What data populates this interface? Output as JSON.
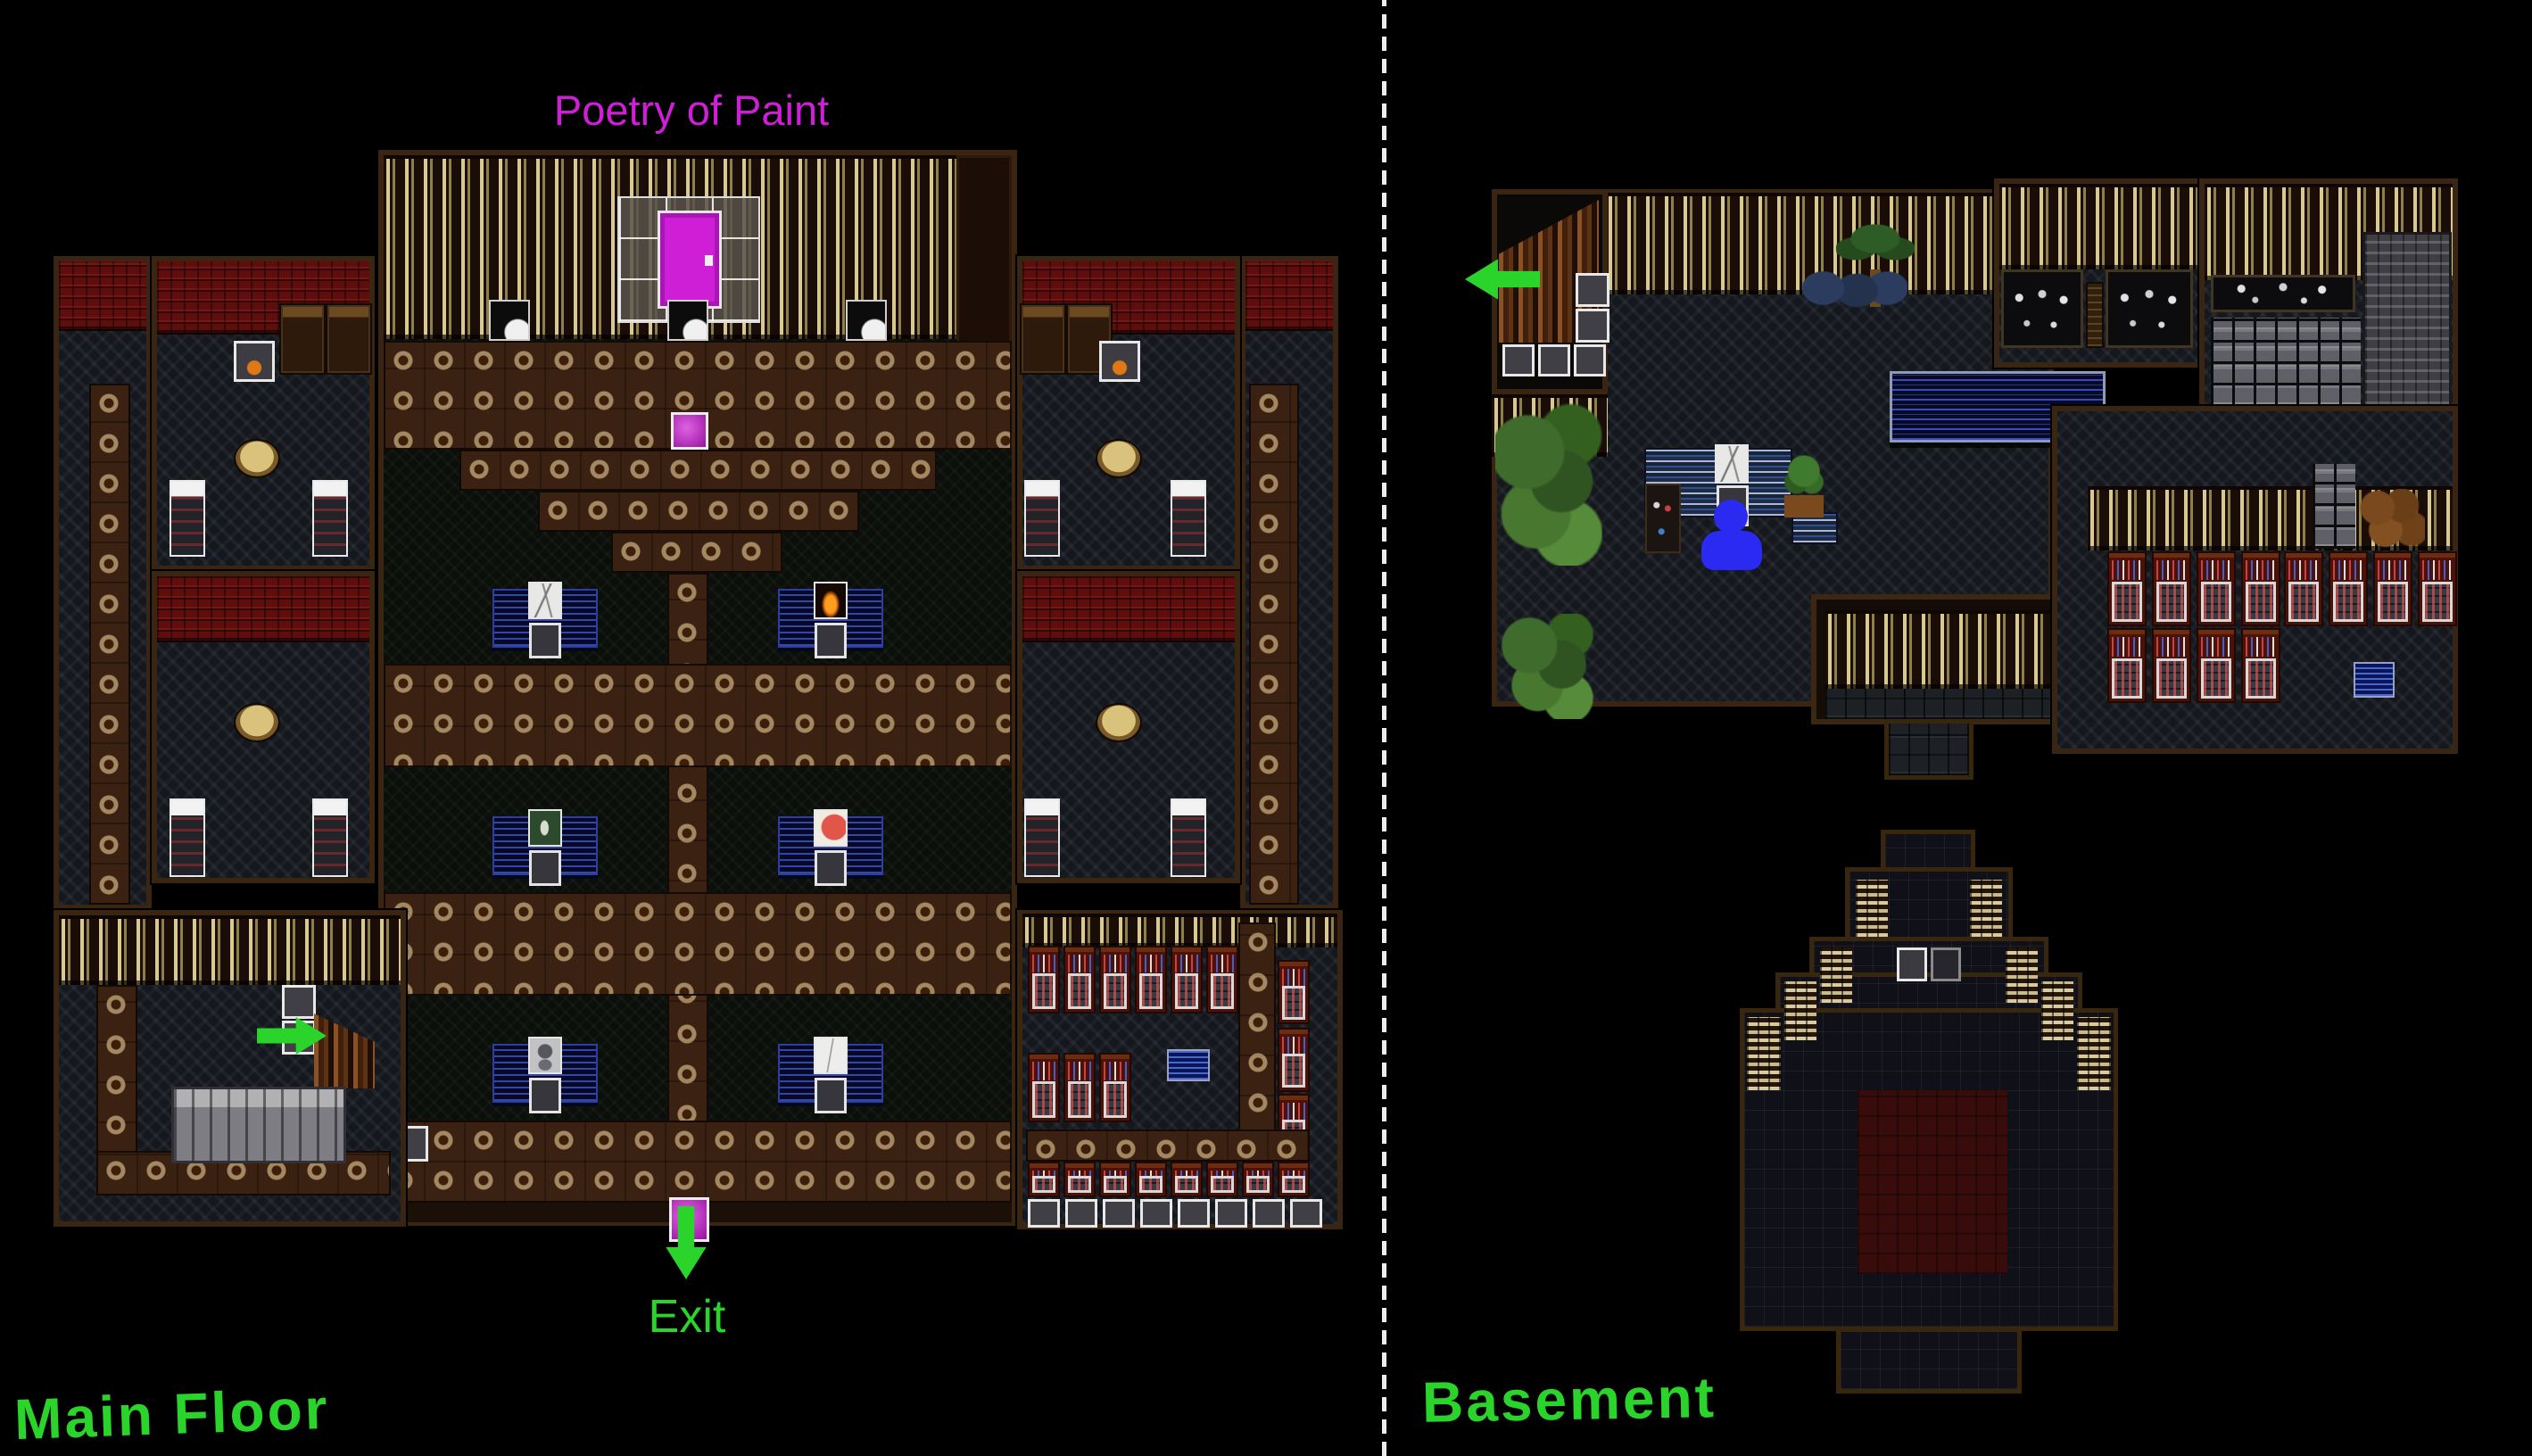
{
  "labels": {
    "gallery_title": "Poetry of Paint",
    "exit": "Exit",
    "left_floor": "Main Floor",
    "right_floor": "Basement"
  },
  "colors": {
    "background": "#000000",
    "annotation_green": "#2bd42b",
    "magenta": "#cf1fd6",
    "marker_blue": "#2a2af2",
    "divider_white": "#ededed"
  },
  "icons": {
    "left_map": [
      "magenta-door-icon",
      "magenta-floor-tile-icon",
      "green-arrow-right-icon",
      "magenta-exit-tile-icon",
      "green-arrow-down-icon"
    ],
    "right_map": [
      "green-arrow-left-icon",
      "blue-person-marker-icon"
    ]
  }
}
